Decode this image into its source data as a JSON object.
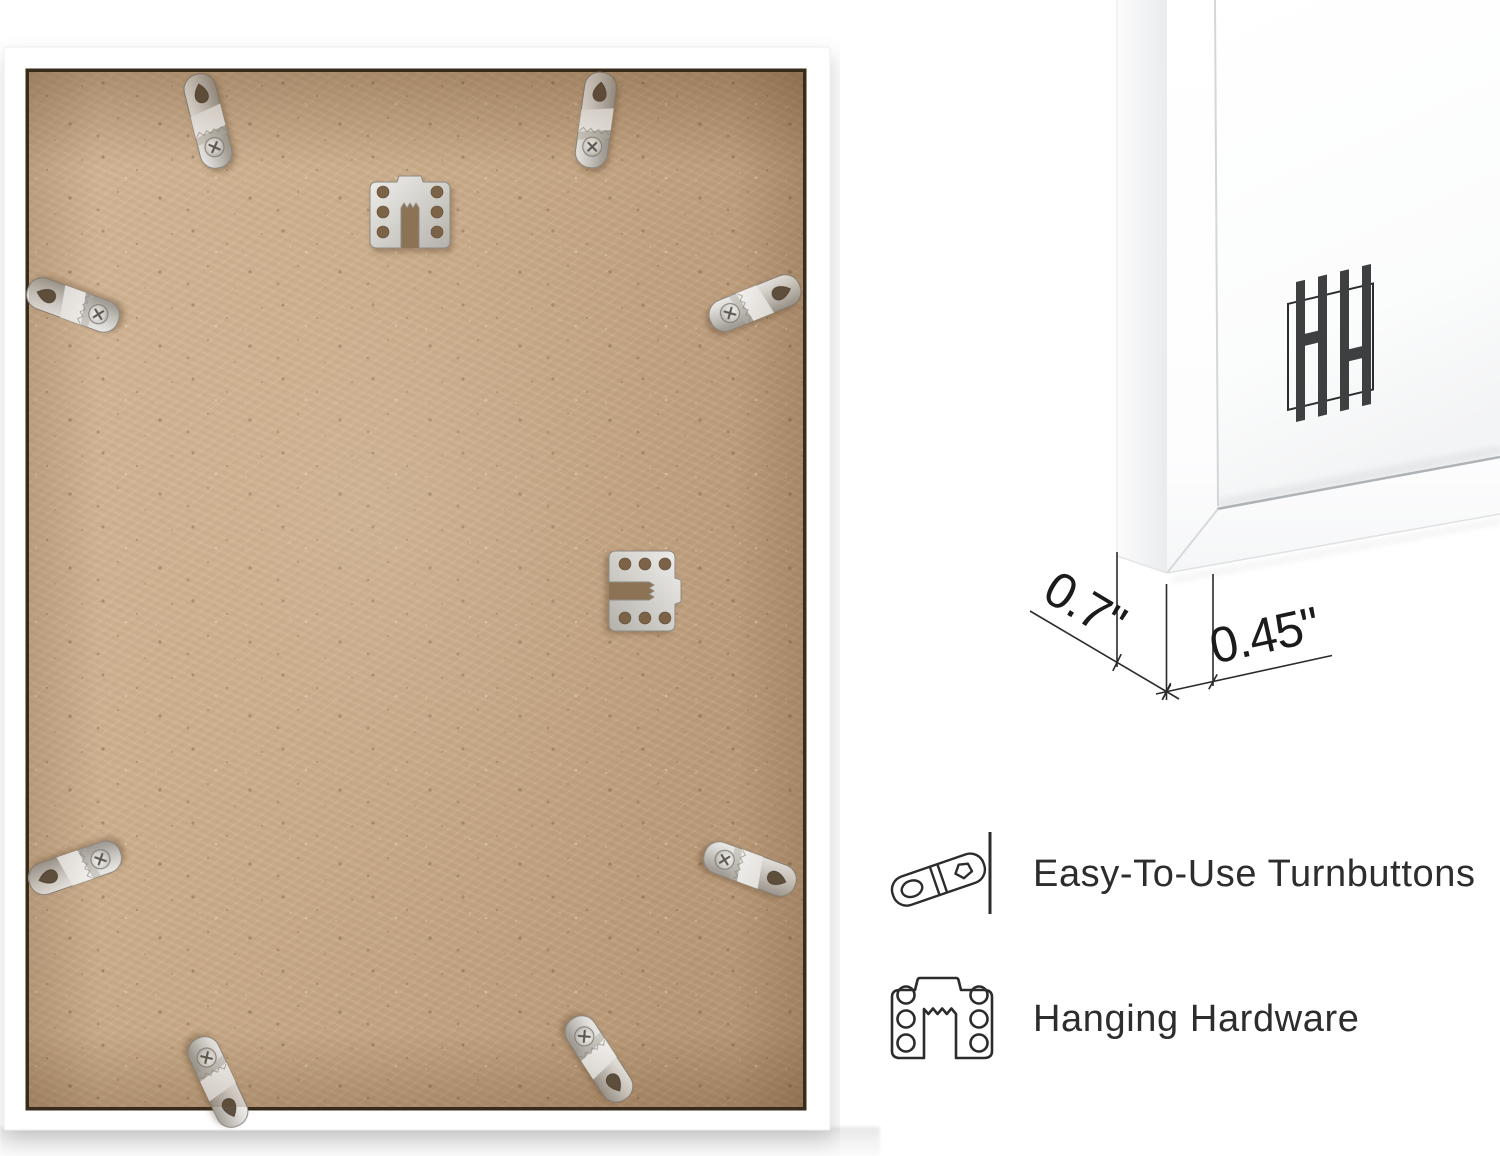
{
  "product_image": {
    "back_view_name": "frame-back-photo",
    "corner_view_name": "frame-corner-closeup"
  },
  "dimensions": {
    "depth_label": "0.7\"",
    "face_label": "0.45\""
  },
  "features": [
    {
      "icon": "turnbutton-outline-icon",
      "label": "Easy-To-Use Turnbuttons"
    },
    {
      "icon": "hanging-hardware-outline-icon",
      "label": "Hanging Hardware"
    }
  ],
  "logo": {
    "icon": "hh-monogram-logo",
    "monogram": "HH"
  },
  "hardware": {
    "turnbuttons_visible": 8,
    "sawtooth_hangers_visible": 2
  },
  "colors": {
    "background": "#ffffff",
    "mdf_tan": "#c6a787",
    "frame_white": "#ffffff",
    "metal": "#cfccc6",
    "annotation_dark": "#2b2b2b",
    "text_dark": "#2d2d2d"
  }
}
